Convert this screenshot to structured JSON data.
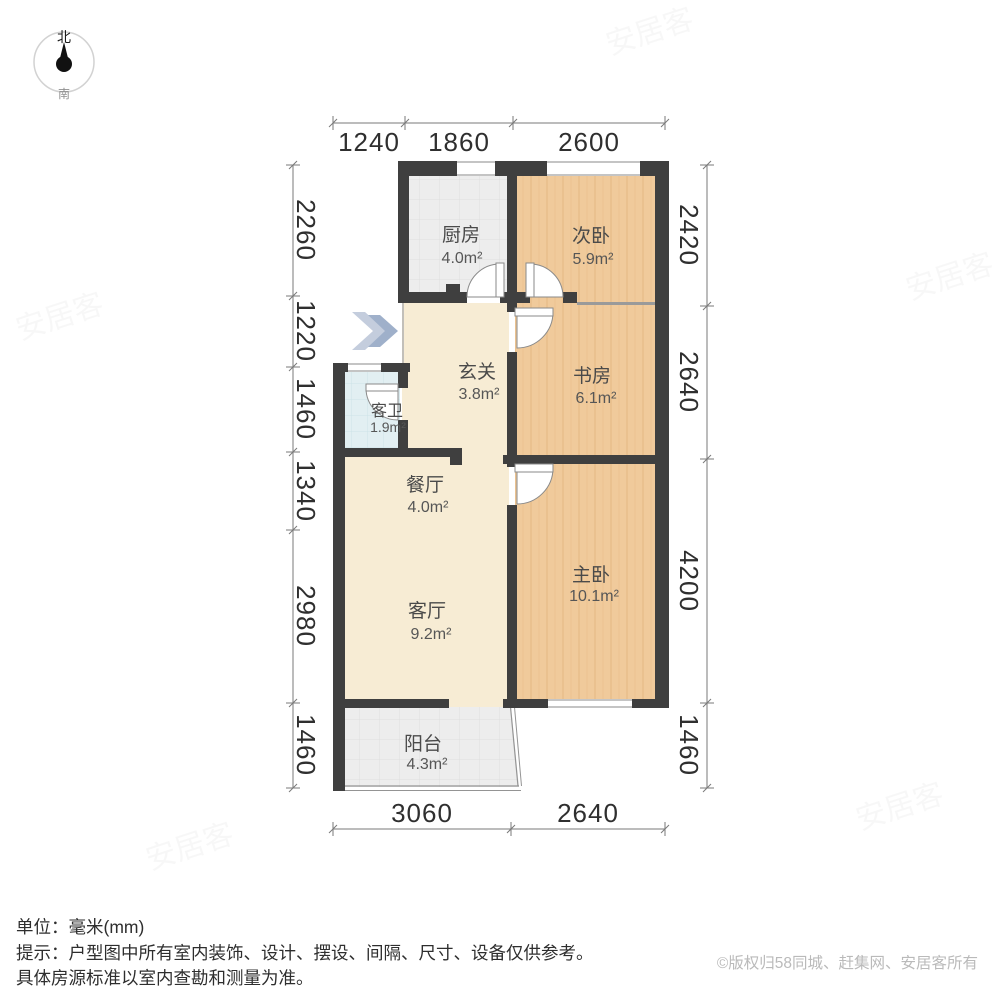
{
  "compass": {
    "north": "北",
    "south": "南"
  },
  "rooms": [
    {
      "id": "kitchen",
      "name": "厨房",
      "area": "4.0m²"
    },
    {
      "id": "second-bedroom",
      "name": "次卧",
      "area": "5.9m²"
    },
    {
      "id": "study",
      "name": "书房",
      "area": "6.1m²"
    },
    {
      "id": "hallway",
      "name": "玄关",
      "area": "3.8m²"
    },
    {
      "id": "guest-bath",
      "name": "客卫",
      "area": "1.9m²"
    },
    {
      "id": "dining",
      "name": "餐厅",
      "area": "4.0m²"
    },
    {
      "id": "living",
      "name": "客厅",
      "area": "9.2m²"
    },
    {
      "id": "master-bedroom",
      "name": "主卧",
      "area": "10.1m²"
    },
    {
      "id": "balcony",
      "name": "阳台",
      "area": "4.3m²"
    }
  ],
  "dimensions": {
    "top": [
      "1240",
      "1860",
      "2600"
    ],
    "bottom": [
      "3060",
      "2640"
    ],
    "left": [
      "2260",
      "1220",
      "1460",
      "1340",
      "2980",
      "1460"
    ],
    "right": [
      "2420",
      "2640",
      "4200",
      "1460"
    ]
  },
  "footer": {
    "unit": "单位：毫米(mm)",
    "tip_line1": "提示：户型图中所有室内装饰、设计、摆设、间隔、尺寸、设备仅供参考。",
    "tip_line2": "具体房源标准以室内查勘和测量为准。",
    "copyright": "©版权归58同城、赶集网、安居客所有"
  },
  "watermark": "安居客",
  "colors": {
    "wall": "#3f3f3f",
    "wood_floor": "#f0ca9b",
    "beige_floor": "#f7ecd4",
    "gray_tile": "#ededed",
    "blue_tile": "#e2eff2",
    "dimension_text": "#2f2f2f",
    "copyright_text": "#bababa",
    "entry_arrow": "#a3b2cc"
  }
}
